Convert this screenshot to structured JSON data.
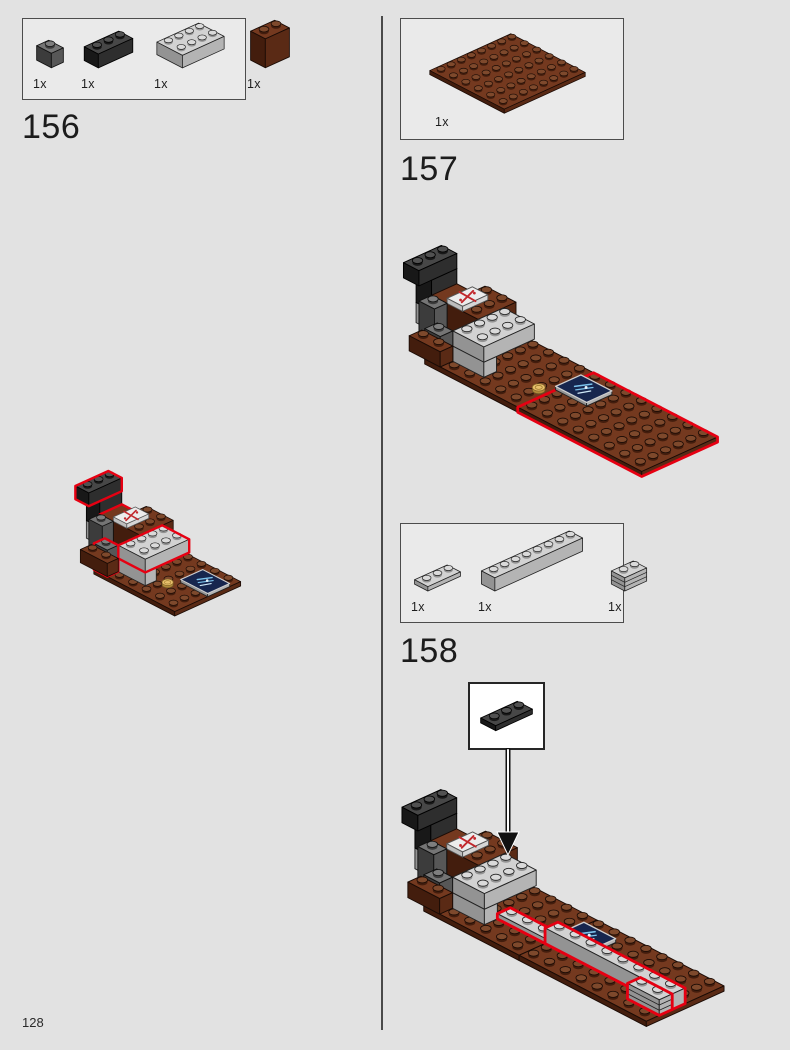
{
  "page": {
    "number": "128"
  },
  "colors": {
    "background": "#e2e2e2",
    "box_fill": "#eaeaea",
    "box_border": "#4c4c4c",
    "divider": "#4a4a4a",
    "callout_fill": "#ffffff",
    "highlight_red": "#e60012",
    "lego": {
      "black": {
        "t": "#474747",
        "f": "#181818",
        "r": "#2e2e2e",
        "s": "#515151",
        "e": "#000000"
      },
      "dkgray": {
        "t": "#757575",
        "f": "#3c3c3c",
        "r": "#575757",
        "s": "#7e7e7e",
        "e": "#111111"
      },
      "gray": {
        "t": "#d2d2d2",
        "f": "#939393",
        "r": "#b4b4b4",
        "s": "#dadada",
        "e": "#222222"
      },
      "brown": {
        "t": "#74391f",
        "f": "#431d0d",
        "r": "#5a2a15",
        "s": "#7e492c",
        "e": "#1a0b05"
      },
      "white": {
        "t": "#ececec",
        "f": "#bdbdbd",
        "r": "#d6d6d6",
        "s": "#f2f2f2",
        "e": "#555555"
      },
      "blue_tile_top": "#17264e",
      "blue_tile_print": "#7cc3ec",
      "tile_print_red": "#c1282d",
      "gold_top": "#e8c06c",
      "gold_side": "#b08a3c"
    }
  },
  "steps": [
    {
      "label": "156",
      "parts": [
        {
          "name": "brick-1x1-dark-gray",
          "count": "1x"
        },
        {
          "name": "brick-1x3-black",
          "count": "1x"
        },
        {
          "name": "brick-2x4-light-gray",
          "count": "1x"
        },
        {
          "name": "panel-1x2x2-reddish-brown",
          "count": "1x"
        }
      ]
    },
    {
      "label": "157",
      "parts": [
        {
          "name": "plate-6x8-reddish-brown",
          "count": "1x"
        }
      ]
    },
    {
      "label": "158",
      "parts": [
        {
          "name": "plate-1x3-light-gray",
          "count": "1x"
        },
        {
          "name": "brick-1x8-light-gray",
          "count": "1x"
        },
        {
          "name": "brick-1x2-masonry-light-gray",
          "count": "1x"
        }
      ],
      "callout_part": {
        "name": "plate-1x3-black"
      }
    }
  ]
}
